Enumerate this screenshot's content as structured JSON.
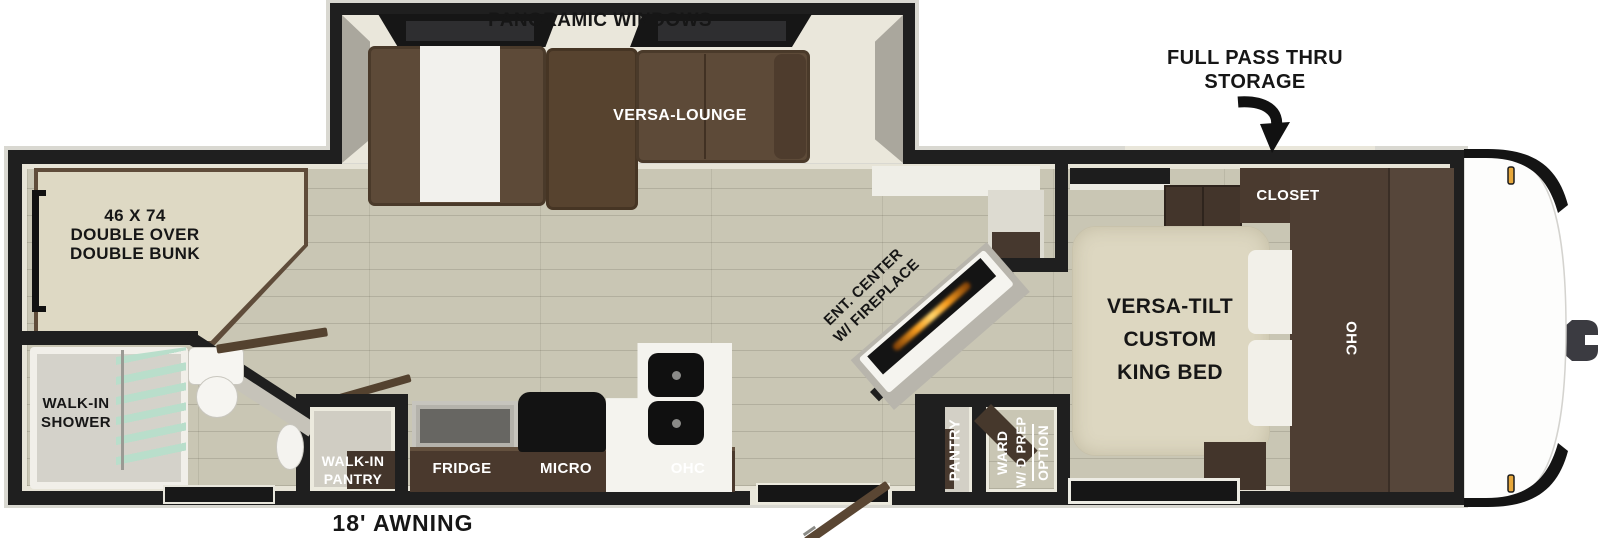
{
  "labels": {
    "panoramic_windows": "PANORAMIC WINDOWS",
    "versa_lounge": "VERSA-LOUNGE",
    "full_pass_thru_line1": "FULL PASS THRU",
    "full_pass_thru_line2": "STORAGE",
    "closet": "CLOSET",
    "bunk_line1": "46 X 74",
    "bunk_line2": "DOUBLE OVER",
    "bunk_line3": "DOUBLE BUNK",
    "king_bed_line1": "VERSA-TILT",
    "king_bed_line2": "CUSTOM",
    "king_bed_line3": "KING BED",
    "bedroom_ohc": "OHC",
    "ent_center_line1": "ENT. CENTER",
    "ent_center_line2": "W/ FIREPLACE",
    "shower_line1": "WALK-IN",
    "shower_line2": "SHOWER",
    "walkin_pantry_line1": "WALK-IN",
    "walkin_pantry_line2": "PANTRY",
    "fridge": "FRIDGE",
    "micro": "MICRO",
    "kitchen_ohc": "OHC",
    "pantry": "PANTRY",
    "ward_line1": "WARD",
    "ward_line2": "W/ D PREP",
    "ward_line3": "OPTION",
    "awning": "18' AWNING"
  },
  "colors": {
    "wall": "#1f1f1f",
    "floor": "#c9c6b4",
    "sofa_brown": "#5d4a38",
    "cabinet_brown": "#46382e",
    "bed_cream": "#ddd7c1",
    "fireplace_orange": "#f59b1e",
    "marker_light_amber": "#e7a83c",
    "label_dark": "#161616",
    "label_light": "#ffffff"
  }
}
